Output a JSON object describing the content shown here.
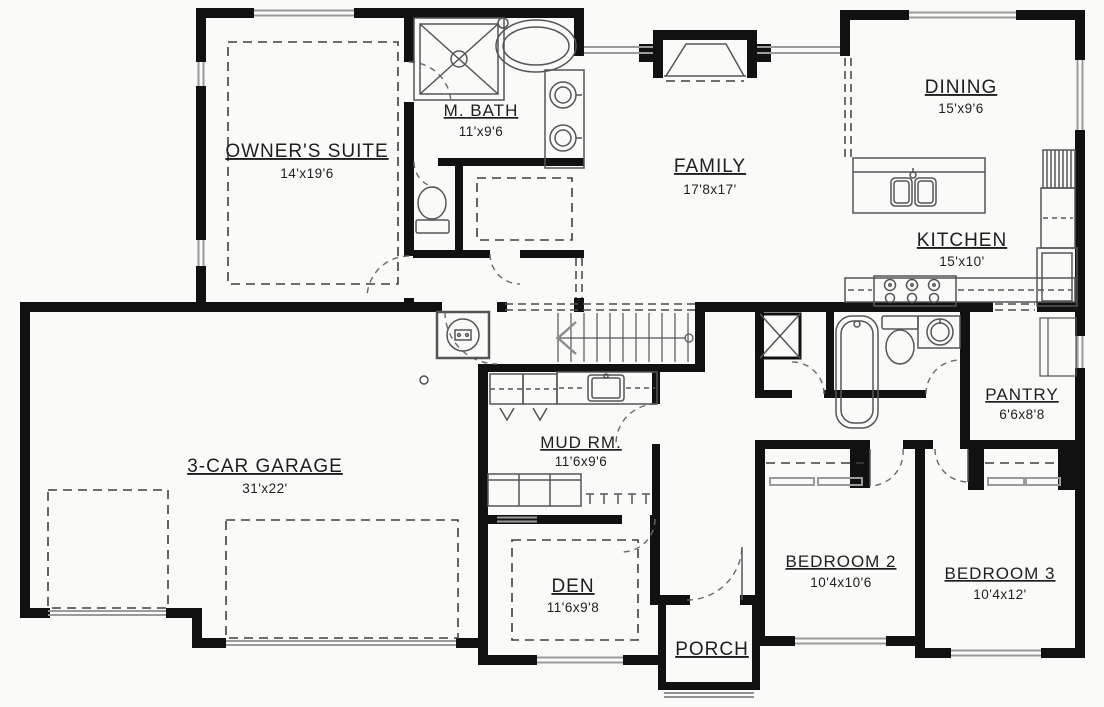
{
  "plan": {
    "title": "single-story house floor plan",
    "rooms": [
      {
        "id": "owners-suite",
        "name": "OWNER'S SUITE",
        "dims": "14'x19'6"
      },
      {
        "id": "m-bath",
        "name": "M. BATH",
        "dims": "11'x9'6"
      },
      {
        "id": "family",
        "name": "FAMILY",
        "dims": "17'8x17'"
      },
      {
        "id": "dining",
        "name": "DINING",
        "dims": "15'x9'6"
      },
      {
        "id": "kitchen",
        "name": "KITCHEN",
        "dims": "15'x10'"
      },
      {
        "id": "pantry",
        "name": "PANTRY",
        "dims": "6'6x8'8"
      },
      {
        "id": "garage",
        "name": "3-CAR GARAGE",
        "dims": "31'x22'"
      },
      {
        "id": "mud-room",
        "name": "MUD RM.",
        "dims": "11'6x9'6"
      },
      {
        "id": "den",
        "name": "DEN",
        "dims": "11'6x9'8"
      },
      {
        "id": "porch",
        "name": "PORCH",
        "dims": ""
      },
      {
        "id": "bedroom-2",
        "name": "BEDROOM 2",
        "dims": "10'4x10'6"
      },
      {
        "id": "bedroom-3",
        "name": "BEDROOM 3",
        "dims": "10'4x12'"
      }
    ],
    "fixtures": [
      "shower",
      "soaking-tub",
      "double-vanity",
      "toilet",
      "walk-in-closet-rods",
      "water-heater",
      "furnace",
      "stairs",
      "fireplace",
      "kitchen-island-sink",
      "range",
      "refrigerator",
      "tall-cabinet",
      "pantry-shelves",
      "bathtub",
      "toilet-2",
      "vanity-sink",
      "linen-chase",
      "mud-sink",
      "lockers",
      "bench-cubbies",
      "coat-hooks",
      "garage-doors",
      "front-door",
      "porch-steps"
    ],
    "colors": {
      "wall": "#111111",
      "fixture_line": "#555555",
      "window": "#9a9a9a",
      "dash": "#4c4c4c",
      "label": "#1e1e1e",
      "background": "#fafaf8"
    }
  }
}
